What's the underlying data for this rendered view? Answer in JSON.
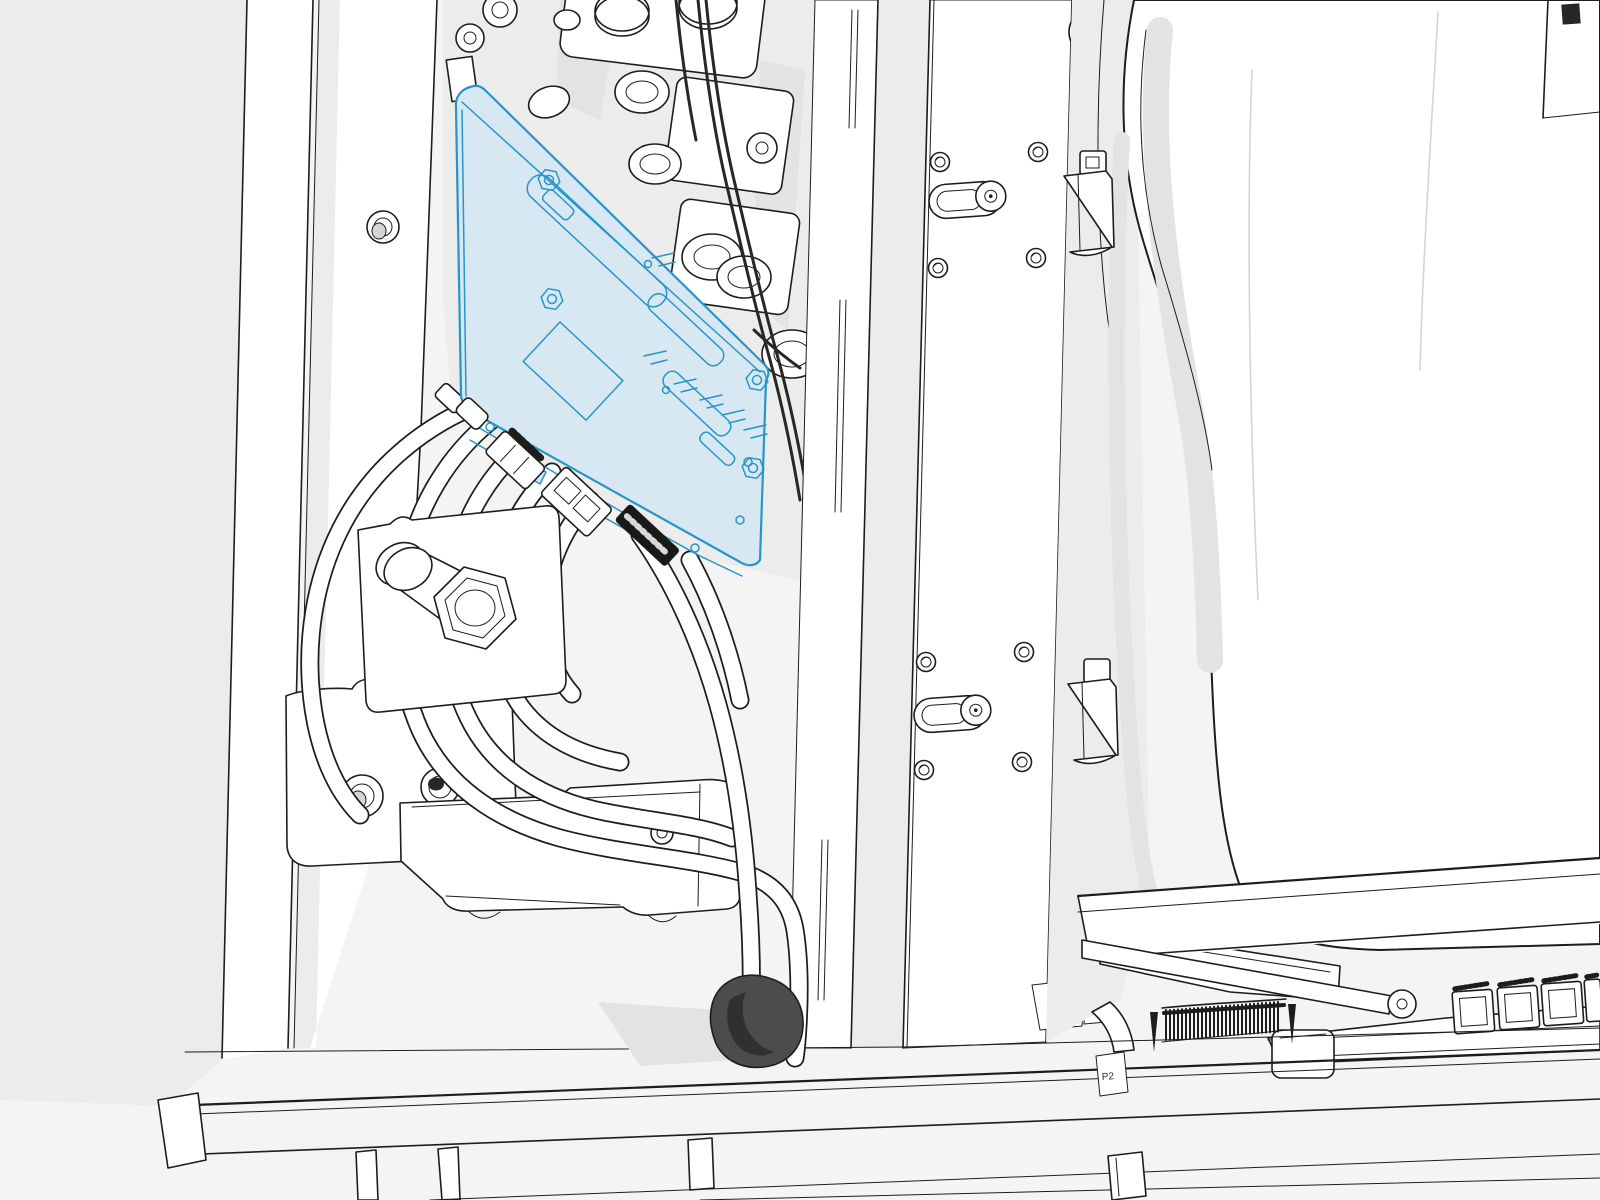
{
  "illustration": {
    "labels": {
      "connector": "P2"
    },
    "highlighted_part": "control-board",
    "colors": {
      "bg": "#f4f4f2",
      "panel": "#ffffff",
      "line": "#1d1d1b",
      "shade1": "#ececea",
      "shade2": "#e3e3e1",
      "shade3": "#d4d4d2",
      "hl-fill": "#d8e8f2",
      "hl-stroke": "#2795c9",
      "wire": "#272725",
      "blob": "#4c4c4a",
      "black-part": "#191917"
    }
  }
}
